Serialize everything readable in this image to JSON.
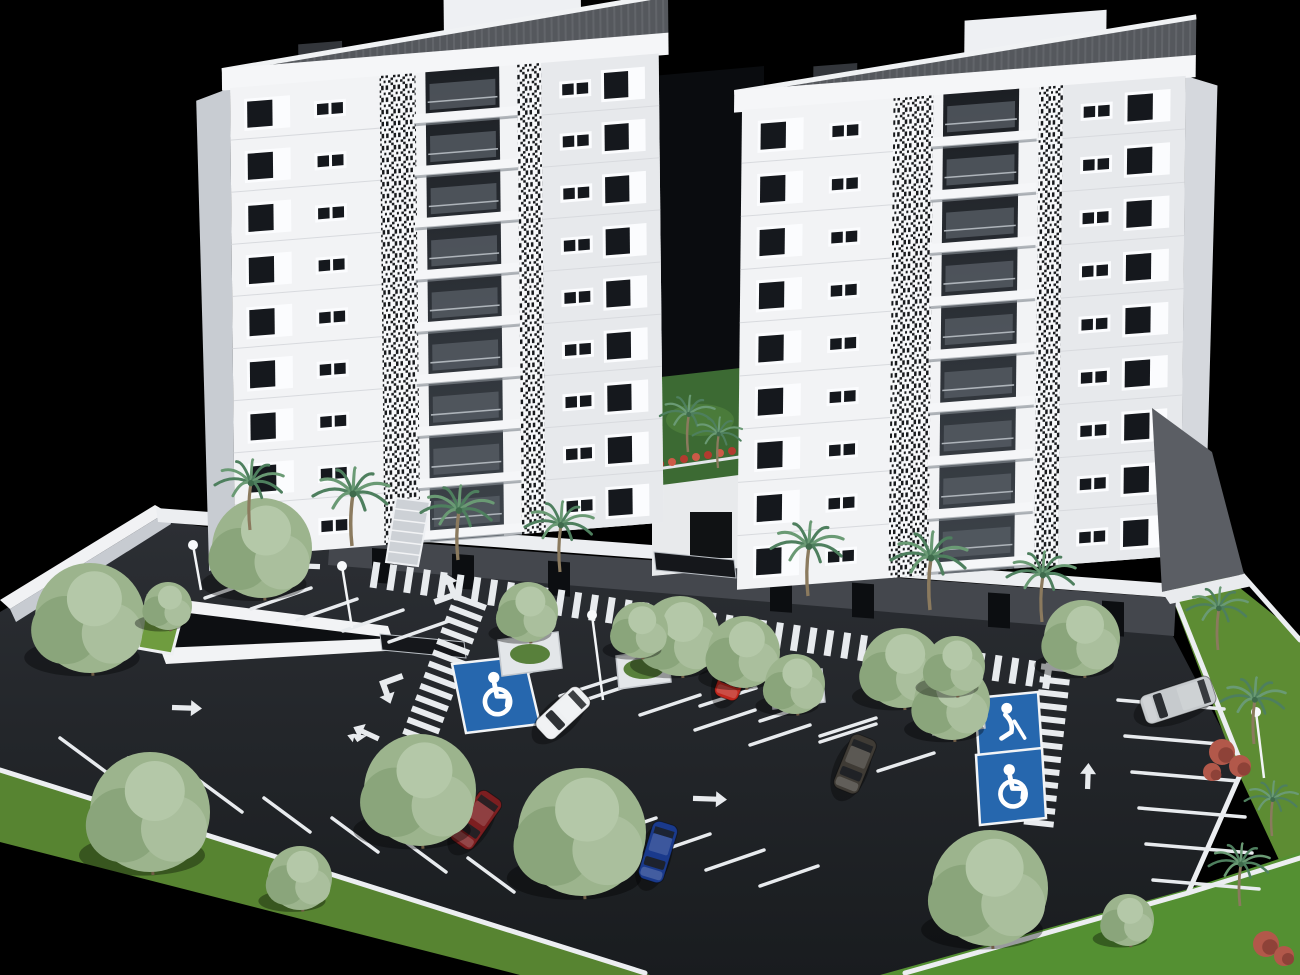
{
  "scene": {
    "title": "3D architectural rendering of twin white residential towers with landscaped surface parking lot, palm trees and accessible parking bays on a black background",
    "palette": {
      "background": "#000000",
      "asphalt_light": "#2c2f34",
      "asphalt_dark": "#191c1f",
      "grass": "#5d8c33",
      "grass_dark": "#49702a",
      "facade_white": "#f2f3f5",
      "facade_gray": "#e7e9ec",
      "facade_side": "#c8ccd2",
      "window_glass": "#15181d",
      "window_frame": "#fbfcfe",
      "roof_gray": "#55585d",
      "plinth_gray": "#44474d",
      "curb_white": "#eceef1",
      "marking_white": "#e8ebee",
      "handicap_blue": "#2667ae",
      "balcony_dark": "#1c1f24",
      "tree_green": "#9cb48d",
      "palm_green": "#4e7f5e",
      "flower_red": "#b23b2f",
      "car_shadow": "#000000"
    }
  },
  "buildings": {
    "towers": [
      {
        "name": "tower-left",
        "x": 230,
        "y": 88,
        "rotate": -4.6,
        "skew": -4,
        "width": 430,
        "height": 468,
        "floors": 9,
        "row_height": 52,
        "side": "left",
        "layout": {
          "big": [
            14,
            46
          ],
          "pair": [
            84,
            32
          ],
          "qr1": [
            150,
            36
          ],
          "balc": [
            196,
            74
          ],
          "qr2": [
            288,
            24
          ],
          "pair2": [
            330,
            32
          ],
          "big2": [
            372,
            44
          ]
        }
      },
      {
        "name": "tower-right",
        "x": 742,
        "y": 110,
        "rotate": -4.4,
        "skew": -5,
        "width": 445,
        "height": 478,
        "floors": 9,
        "row_height": 53,
        "side": "right",
        "layout": {
          "big": [
            16,
            46
          ],
          "pair": [
            88,
            32
          ],
          "qr1": [
            152,
            40
          ],
          "balc": [
            202,
            76
          ],
          "qr2": [
            298,
            24
          ],
          "pair2": [
            340,
            32
          ],
          "big2": [
            384,
            46
          ]
        }
      }
    ],
    "courtyard": {
      "gap": [
        [
          652,
          76
        ],
        [
          764,
          66
        ],
        [
          764,
          566
        ],
        [
          652,
          576
        ]
      ],
      "garden": [
        [
          652,
          378
        ],
        [
          758,
          366
        ],
        [
          762,
          472
        ],
        [
          654,
          486
        ]
      ],
      "railing_from": [
        650,
        470
      ],
      "railing_to": [
        760,
        454
      ],
      "flowers": [
        [
          660,
          464
        ],
        [
          672,
          462
        ],
        [
          684,
          459
        ],
        [
          696,
          457
        ],
        [
          708,
          455
        ],
        [
          720,
          453
        ],
        [
          732,
          451
        ],
        [
          744,
          449
        ]
      ],
      "lower_wall": [
        [
          652,
          472
        ],
        [
          760,
          456
        ],
        [
          762,
          566
        ],
        [
          652,
          576
        ]
      ],
      "door": [
        690,
        512,
        42,
        46
      ]
    },
    "plinth": {
      "face": [
        [
          330,
          537
        ],
        [
          1176,
          598
        ],
        [
          1174,
          636
        ],
        [
          328,
          565
        ]
      ],
      "top_y0": 537,
      "top_x0": 330,
      "slope": 0.0721,
      "opening_xs": [
        372,
        452,
        548,
        770,
        852,
        988,
        1102
      ]
    },
    "sidewalk_band": [
      [
        156,
        508
      ],
      [
        1176,
        584
      ],
      [
        1178,
        598
      ],
      [
        158,
        522
      ]
    ],
    "boundary_wall_top": [
      [
        0,
        600
      ],
      [
        155,
        505
      ],
      [
        167,
        512
      ],
      [
        10,
        609
      ]
    ],
    "boundary_wall_face": [
      [
        10,
        609
      ],
      [
        167,
        512
      ],
      [
        171,
        524
      ],
      [
        16,
        622
      ]
    ],
    "stairs": {
      "poly": [
        [
          396,
          498
        ],
        [
          430,
          502
        ],
        [
          418,
          566
        ],
        [
          386,
          562
        ]
      ],
      "steps": 6
    },
    "canopies": [
      [
        [
          380,
          634
        ],
        [
          464,
          642
        ],
        [
          466,
          658
        ],
        [
          382,
          650
        ]
      ],
      [
        [
          654,
          552
        ],
        [
          734,
          560
        ],
        [
          736,
          578
        ],
        [
          656,
          570
        ]
      ]
    ],
    "gable_wall": [
      [
        1152,
        408
      ],
      [
        1212,
        452
      ],
      [
        1244,
        574
      ],
      [
        1162,
        592
      ]
    ],
    "gable_walk": [
      [
        1162,
        592
      ],
      [
        1244,
        574
      ],
      [
        1252,
        586
      ],
      [
        1170,
        604
      ]
    ]
  },
  "parking": {
    "surface": [
      [
        158,
        520
      ],
      [
        330,
        545
      ],
      [
        1172,
        634
      ],
      [
        1243,
        770
      ],
      [
        1187,
        895
      ],
      [
        905,
        975
      ],
      [
        640,
        975
      ],
      [
        0,
        772
      ],
      [
        0,
        612
      ]
    ],
    "ramp": {
      "upper_wall": [
        [
          168,
          598
        ],
        [
          388,
          626
        ],
        [
          392,
          638
        ],
        [
          164,
          610
        ]
      ],
      "pit": [
        [
          170,
          610
        ],
        [
          390,
          634
        ],
        [
          394,
          642
        ],
        [
          168,
          650
        ]
      ],
      "lower_wall": [
        [
          160,
          648
        ],
        [
          398,
          638
        ],
        [
          402,
          650
        ],
        [
          166,
          664
        ]
      ],
      "planter": [
        [
          148,
          596
        ],
        [
          186,
          600
        ],
        [
          172,
          654
        ],
        [
          138,
          648
        ]
      ]
    },
    "line_sets": [
      {
        "start": [
          205,
          598
        ],
        "step": [
          46,
          11
        ],
        "dir": [
          60,
          -21
        ],
        "count": 5
      },
      {
        "start": [
          60,
          738
        ],
        "step": [
          68,
          20
        ],
        "dir": [
          46,
          34
        ],
        "count": 7
      },
      {
        "start": [
          585,
          700
        ],
        "step": [
          55,
          15
        ],
        "dir": [
          60,
          -20
        ],
        "count": 4
      },
      {
        "start": [
          598,
          838
        ],
        "step": [
          54,
          16
        ],
        "dir": [
          58,
          -20
        ],
        "count": 4
      },
      {
        "start": [
          1118,
          700
        ],
        "step": [
          7,
          36
        ],
        "dir": [
          106,
          9
        ],
        "count": 6
      },
      {
        "start": [
          498,
          682
        ],
        "step": [
          62,
          14
        ],
        "dir": [
          56,
          -18
        ],
        "count": 2
      },
      {
        "start": [
          700,
          706
        ],
        "step": [
          60,
          15
        ],
        "dir": [
          56,
          -18
        ],
        "count": 3
      },
      {
        "start": [
          820,
          742
        ],
        "step": [
          58,
          29
        ],
        "dir": [
          56,
          -18
        ],
        "count": 2
      }
    ],
    "crosswalks": [
      {
        "from": [
          375,
          575
        ],
        "to": [
          1062,
          678
        ],
        "width": 26,
        "spacing": 17,
        "stroke": 7
      },
      {
        "from": [
          470,
          602
        ],
        "to": [
          412,
          756
        ],
        "width": 34,
        "spacing": 12,
        "stroke": 6
      },
      {
        "from": [
          1056,
          668
        ],
        "to": [
          1038,
          830
        ],
        "width": 30,
        "spacing": 13,
        "stroke": 6
      }
    ],
    "arrows": [
      {
        "x": 303,
        "y": 566,
        "angle": 182,
        "len": 34,
        "type": "straight"
      },
      {
        "x": 447,
        "y": 590,
        "angle": -20,
        "len": 26,
        "type": "turn"
      },
      {
        "x": 390,
        "y": 688,
        "angle": 160,
        "len": 24,
        "type": "turn"
      },
      {
        "x": 366,
        "y": 733,
        "angle": -65,
        "len": 28,
        "type": "fork"
      },
      {
        "x": 187,
        "y": 708,
        "angle": 2,
        "len": 30,
        "type": "straight"
      },
      {
        "x": 710,
        "y": 799,
        "angle": 2,
        "len": 34,
        "type": "straight"
      },
      {
        "x": 1088,
        "y": 776,
        "angle": -88,
        "len": 26,
        "type": "straight"
      },
      {
        "x": 958,
        "y": 660,
        "angle": 182,
        "len": 26,
        "type": "straight"
      }
    ],
    "accessible_spots": [
      {
        "poly": [
          [
            452,
            664
          ],
          [
            524,
            656
          ],
          [
            540,
            724
          ],
          [
            466,
            733
          ]
        ],
        "icon": "wheelchair-icon"
      },
      {
        "poly": [
          [
            975,
            698
          ],
          [
            1038,
            692
          ],
          [
            1042,
            752
          ],
          [
            979,
            758
          ]
        ],
        "icon": "person-cane-icon"
      },
      {
        "poly": [
          [
            976,
            755
          ],
          [
            1042,
            748
          ],
          [
            1046,
            818
          ],
          [
            980,
            825
          ]
        ],
        "icon": "wheelchair-icon"
      }
    ],
    "planters": [
      [
        [
          498,
          640
        ],
        [
          558,
          632
        ],
        [
          562,
          668
        ],
        [
          502,
          676
        ]
      ],
      [
        [
          616,
          656
        ],
        [
          668,
          649
        ],
        [
          671,
          682
        ],
        [
          619,
          689
        ]
      ],
      [
        [
          770,
          676
        ],
        [
          822,
          669
        ],
        [
          825,
          702
        ],
        [
          773,
          709
        ]
      ],
      [
        [
          930,
          702
        ],
        [
          982,
          695
        ],
        [
          985,
          728
        ],
        [
          933,
          735
        ]
      ]
    ],
    "lamps": [
      {
        "top": [
          193,
          545
        ],
        "base": [
          201,
          590
        ]
      },
      {
        "top": [
          342,
          566
        ],
        "base": [
          352,
          628
        ]
      },
      {
        "top": [
          592,
          615
        ],
        "base": [
          603,
          700
        ]
      },
      {
        "top": [
          1256,
          712
        ],
        "base": [
          1264,
          778
        ]
      }
    ],
    "cars": [
      {
        "name": "white-sedan",
        "color": "#eef0f2",
        "x": 563,
        "y": 713,
        "angle": 137,
        "len": 58,
        "wid": 26
      },
      {
        "name": "red-car",
        "color": "#c1271d",
        "x": 734,
        "y": 672,
        "angle": 110,
        "len": 56,
        "wid": 25
      },
      {
        "name": "maroon-car",
        "color": "#7c1e20",
        "x": 476,
        "y": 820,
        "angle": 125,
        "len": 60,
        "wid": 27
      },
      {
        "name": "blue-sedan",
        "color": "#1a3a8c",
        "x": 658,
        "y": 852,
        "angle": 107,
        "len": 60,
        "wid": 26
      },
      {
        "name": "dark-suv",
        "color": "#3f3b35",
        "x": 855,
        "y": 764,
        "angle": 112,
        "len": 58,
        "wid": 27
      },
      {
        "name": "silver-coupe",
        "color": "#c6cacd",
        "x": 1178,
        "y": 700,
        "angle": 162,
        "len": 74,
        "wid": 30
      }
    ]
  },
  "landscape": {
    "areas": [
      {
        "name": "grass-left-strip",
        "pts": [
          [
            0,
            768
          ],
          [
            650,
            975
          ],
          [
            520,
            975
          ],
          [
            0,
            842
          ]
        ],
        "fill": "#578431"
      },
      {
        "name": "grass-right-slope",
        "pts": [
          [
            1200,
            556
          ],
          [
            1300,
            636
          ],
          [
            1300,
            905
          ],
          [
            1238,
            772
          ],
          [
            1170,
            592
          ]
        ],
        "fill": "#5d8c33"
      },
      {
        "name": "grass-bottom-right",
        "pts": [
          [
            880,
            975
          ],
          [
            1185,
            890
          ],
          [
            1300,
            852
          ],
          [
            1300,
            975
          ]
        ],
        "fill": "#549032"
      }
    ],
    "curbs": [
      [
        [
          0,
          770
        ],
        [
          645,
          973
        ]
      ],
      [
        [
          905,
          973
        ],
        [
          1188,
          893
        ],
        [
          1300,
          858
        ]
      ],
      [
        [
          1172,
          590
        ],
        [
          1243,
          768
        ],
        [
          1188,
          893
        ]
      ],
      [
        [
          1238,
          570
        ],
        [
          1300,
          640
        ]
      ]
    ],
    "trees": [
      [
        90,
        618,
        55
      ],
      [
        262,
        548,
        50
      ],
      [
        168,
        606,
        24
      ],
      [
        150,
        812,
        60
      ],
      [
        420,
        790,
        56
      ],
      [
        582,
        832,
        64
      ],
      [
        680,
        636,
        40
      ],
      [
        744,
        652,
        36
      ],
      [
        902,
        668,
        40
      ],
      [
        952,
        702,
        38
      ],
      [
        1082,
        638,
        38
      ],
      [
        990,
        888,
        58
      ],
      [
        300,
        878,
        32
      ],
      [
        1128,
        920,
        26
      ],
      [
        528,
        612,
        30
      ],
      [
        640,
        630,
        28
      ],
      [
        795,
        684,
        30
      ],
      [
        955,
        666,
        30
      ]
    ],
    "palms": [
      [
        250,
        530,
        0.9
      ],
      [
        352,
        546,
        1.0
      ],
      [
        458,
        560,
        0.95
      ],
      [
        560,
        572,
        0.9
      ],
      [
        808,
        596,
        0.95
      ],
      [
        930,
        610,
        1.0
      ],
      [
        1042,
        622,
        0.9
      ],
      [
        688,
        452,
        0.72
      ],
      [
        718,
        468,
        0.65
      ],
      [
        1218,
        650,
        0.8
      ],
      [
        1254,
        744,
        0.85
      ],
      [
        1240,
        906,
        0.8
      ],
      [
        1272,
        836,
        0.7
      ]
    ],
    "red_shrubs": [
      [
        1222,
        752,
        13
      ],
      [
        1240,
        766,
        11
      ],
      [
        1212,
        772,
        9
      ],
      [
        1266,
        944,
        13
      ],
      [
        1284,
        956,
        10
      ]
    ]
  }
}
